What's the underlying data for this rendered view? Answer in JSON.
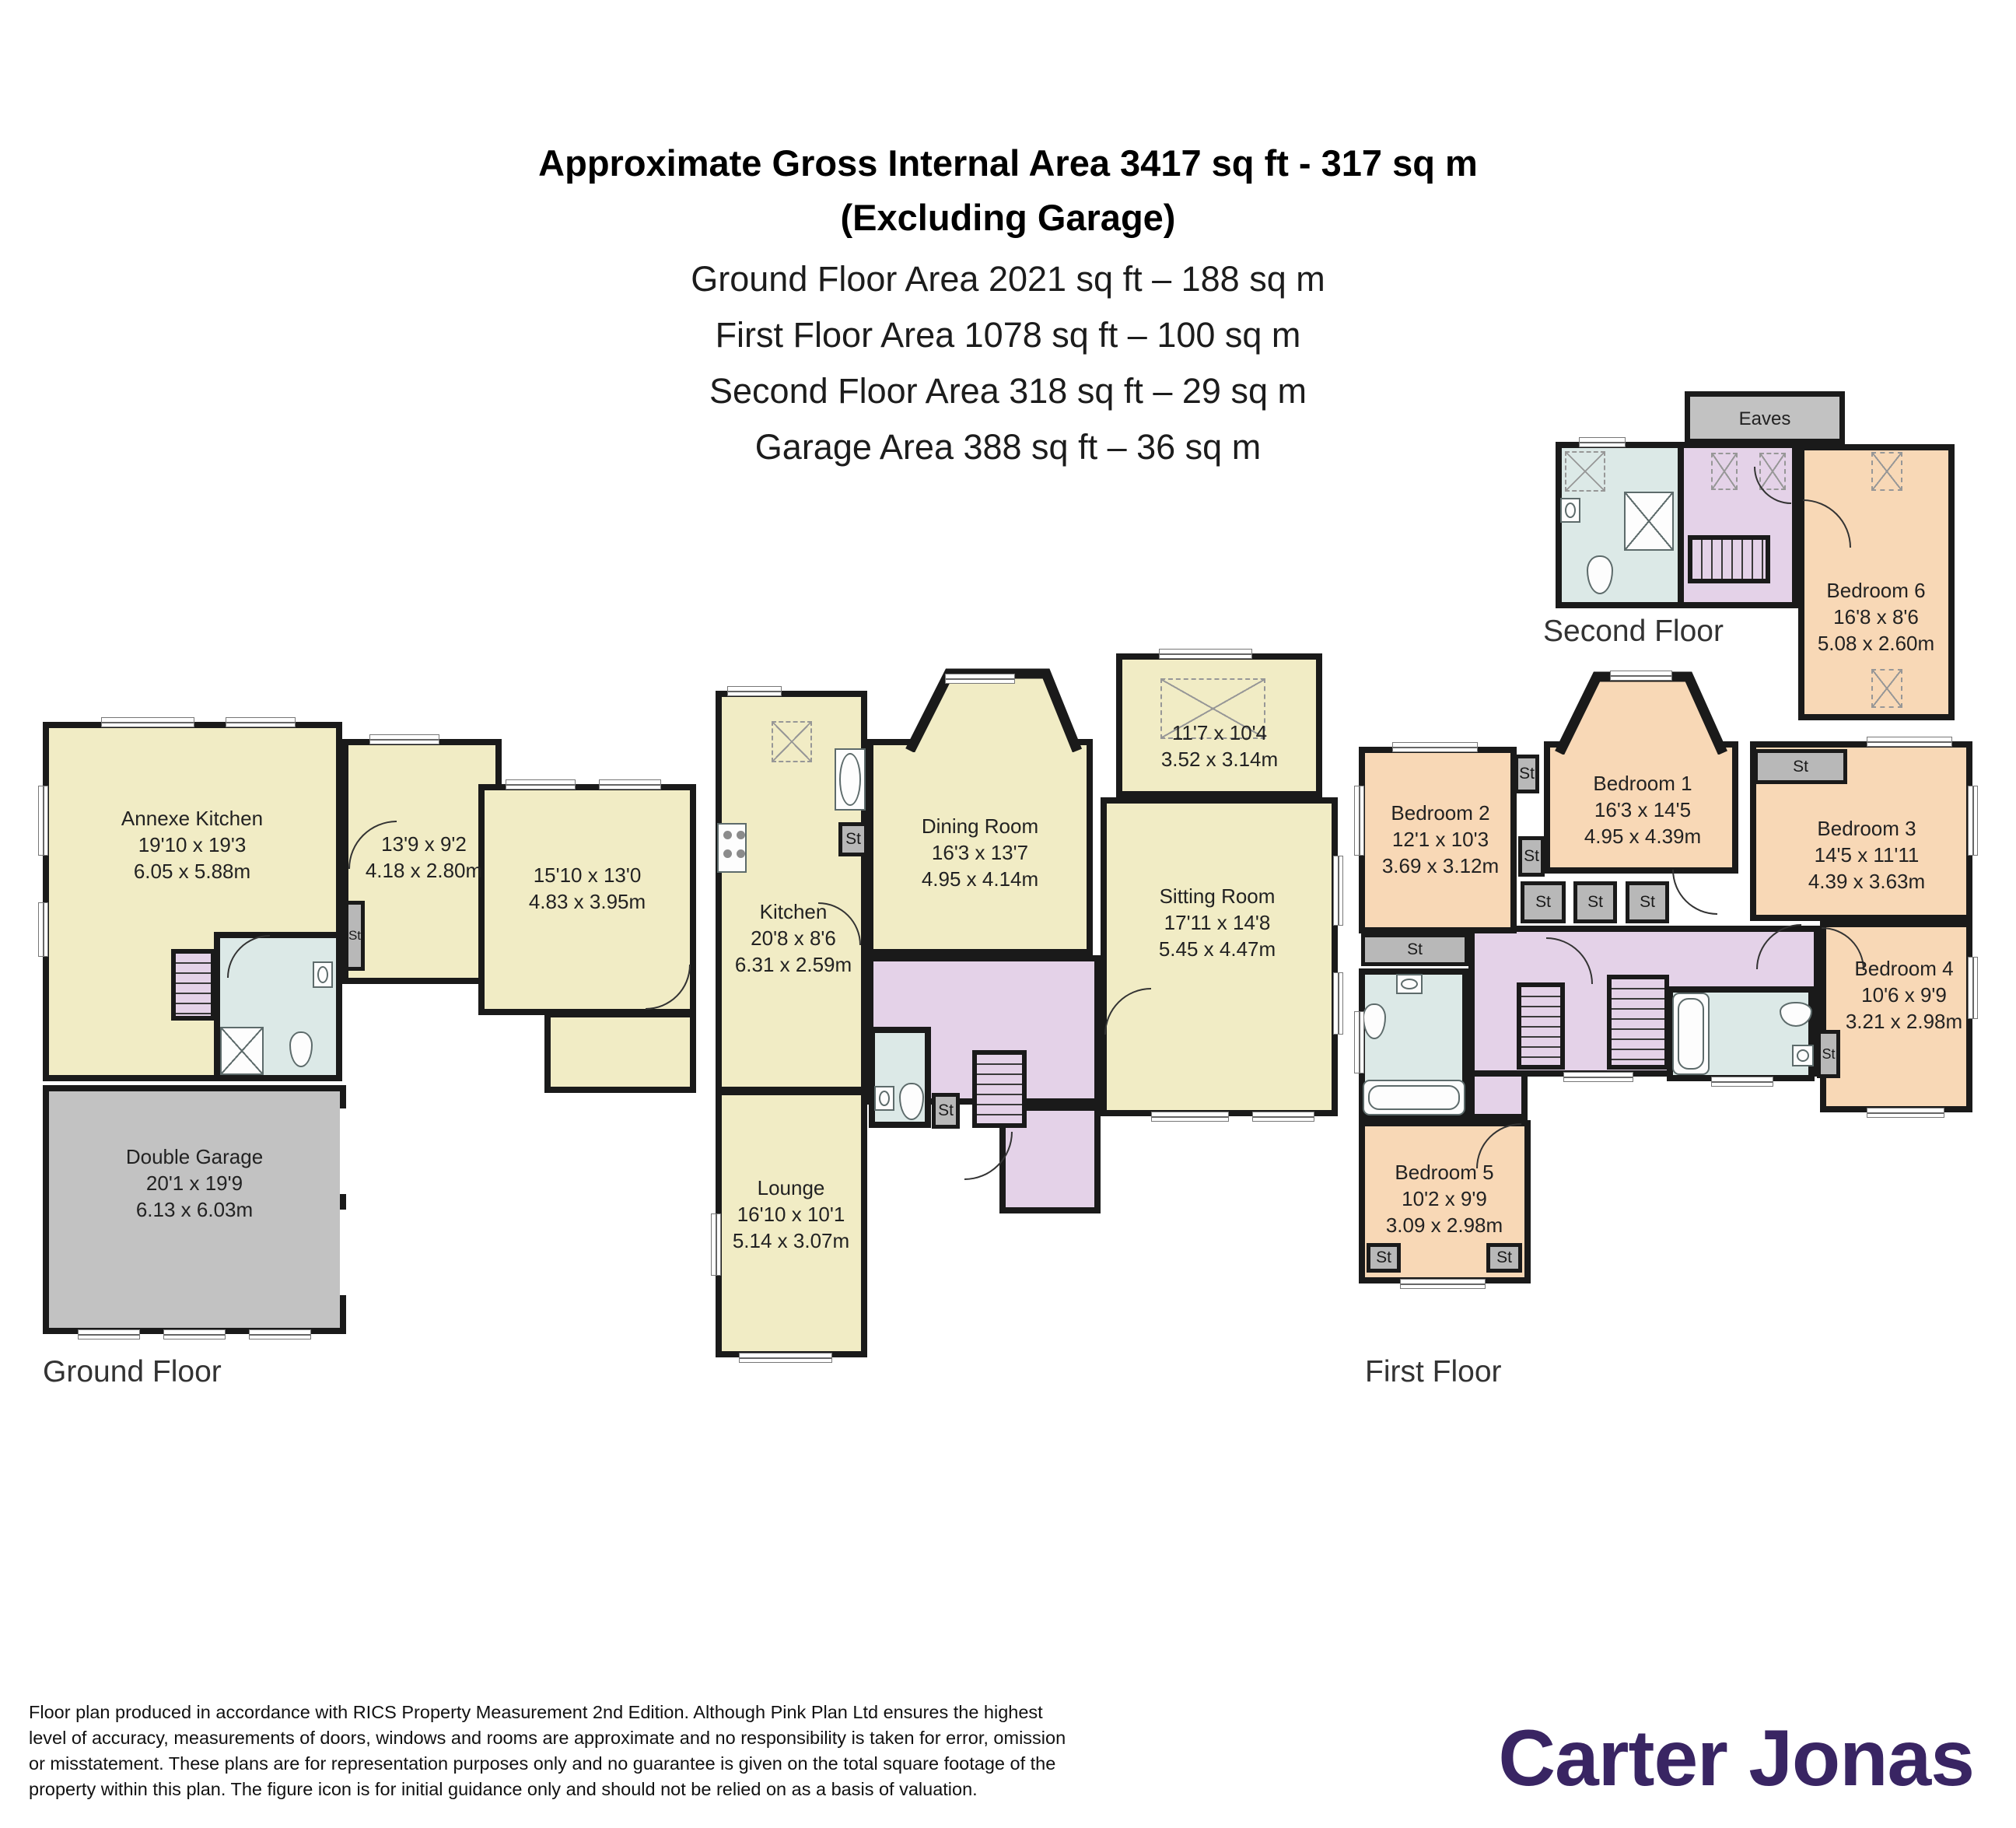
{
  "header": {
    "line1": "Approximate Gross Internal Area 3417 sq ft - 317 sq m",
    "line2": "(Excluding Garage)",
    "area_lines": {
      "ground": "Ground Floor Area 2021 sq ft – 188 sq m",
      "first": "First Floor Area 1078 sq ft – 100 sq m",
      "second": "Second Floor Area 318 sq ft – 29 sq m",
      "garage": "Garage Area 388 sq ft – 36 sq m"
    }
  },
  "st": "St",
  "floors": {
    "ground": {
      "label": "Ground Floor",
      "rooms": {
        "annexe_kitchen": {
          "name": "Annexe Kitchen",
          "imperial": "19'10 x 19'3",
          "metric": "6.05 x 5.88m"
        },
        "room_139": {
          "imperial": "13'9 x 9'2",
          "metric": "4.18 x 2.80m"
        },
        "room_1510": {
          "imperial": "15'10 x 13'0",
          "metric": "4.83 x 3.95m"
        },
        "kitchen": {
          "name": "Kitchen",
          "imperial": "20'8 x 8'6",
          "metric": "6.31 x 2.59m"
        },
        "dining_room": {
          "name": "Dining Room",
          "imperial": "16'3 x 13'7",
          "metric": "4.95 x 4.14m"
        },
        "conservatory": {
          "imperial": "11'7 x 10'4",
          "metric": "3.52 x 3.14m"
        },
        "sitting_room": {
          "name": "Sitting Room",
          "imperial": "17'11 x 14'8",
          "metric": "5.45 x 4.47m"
        },
        "lounge": {
          "name": "Lounge",
          "imperial": "16'10 x 10'1",
          "metric": "5.14 x 3.07m"
        },
        "double_garage": {
          "name": "Double Garage",
          "imperial": "20'1 x 19'9",
          "metric": "6.13 x 6.03m"
        }
      }
    },
    "first": {
      "label": "First Floor",
      "rooms": {
        "bedroom1": {
          "name": "Bedroom 1",
          "imperial": "16'3 x 14'5",
          "metric": "4.95 x 4.39m"
        },
        "bedroom2": {
          "name": "Bedroom 2",
          "imperial": "12'1 x 10'3",
          "metric": "3.69 x 3.12m"
        },
        "bedroom3": {
          "name": "Bedroom 3",
          "imperial": "14'5 x 11'11",
          "metric": "4.39 x 3.63m"
        },
        "bedroom4": {
          "name": "Bedroom 4",
          "imperial": "10'6 x 9'9",
          "metric": "3.21 x 2.98m"
        },
        "bedroom5": {
          "name": "Bedroom 5",
          "imperial": "10'2 x 9'9",
          "metric": "3.09 x 2.98m"
        }
      }
    },
    "second": {
      "label": "Second Floor",
      "eaves": "Eaves",
      "rooms": {
        "bedroom6": {
          "name": "Bedroom 6",
          "imperial": "16'8 x 8'6",
          "metric": "5.08 x 2.60m"
        }
      }
    }
  },
  "footer": {
    "disclaimer_lines": [
      "Floor plan produced in accordance with RICS Property Measurement 2nd Edition. Although Pink Plan Ltd ensures the highest",
      "level of accuracy, measurements of doors, windows and rooms are approximate and no responsibility is taken for error, omission",
      "or misstatement. These plans are for representation purposes only and no guarantee is given on the total square footage of the",
      "property within this plan. The figure icon is for initial guidance only and should not be relied on as a basis of valuation."
    ],
    "brand": "Carter Jonas"
  },
  "colors": {
    "wall": "#1a1a1a",
    "room_cream": "#f1ecc5",
    "bedroom_peach": "#f8d8b6",
    "hall_purple": "#e4d2e8",
    "bathroom_blue": "#dce9e7",
    "garage_gray": "#c2c2c2",
    "storage_gray": "#b8b8b8",
    "brand_purple": "#392563"
  }
}
